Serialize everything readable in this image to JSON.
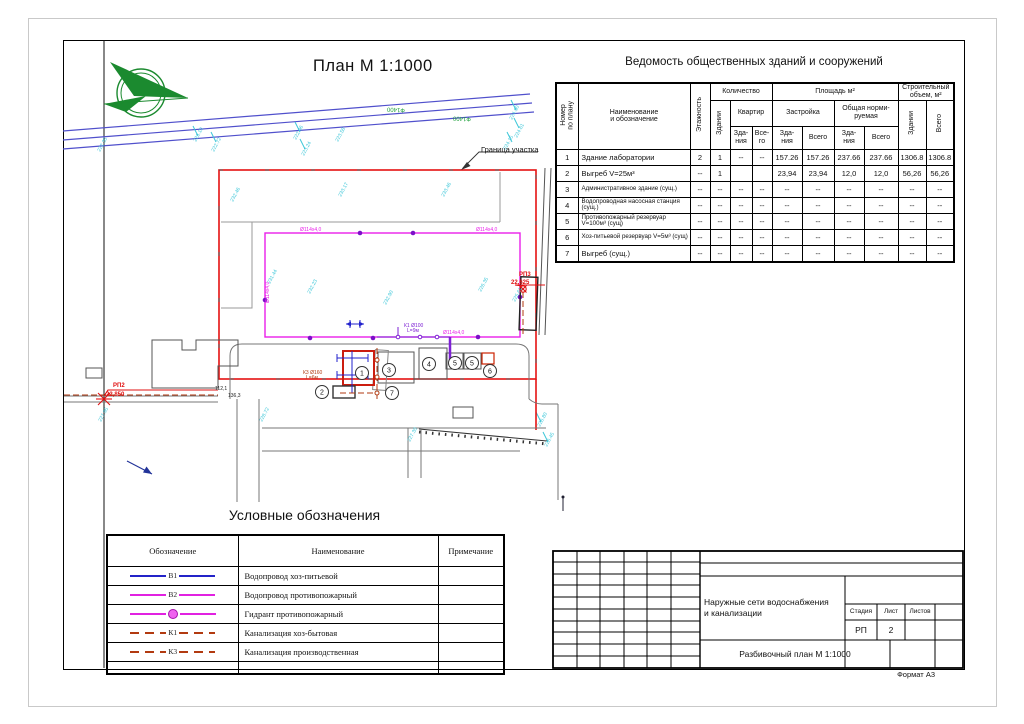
{
  "page": {
    "format_label": "Формат А3"
  },
  "plan": {
    "title": "План М 1:1000",
    "boundary_label": "Граница участка",
    "building_markers": [
      {
        "n": "1",
        "x": 362,
        "y": 373
      },
      {
        "n": "2",
        "x": 322,
        "y": 392
      },
      {
        "n": "3",
        "x": 389,
        "y": 370
      },
      {
        "n": "4",
        "x": 429,
        "y": 364
      },
      {
        "n": "5",
        "x": 455,
        "y": 363
      },
      {
        "n": "5",
        "x": 472,
        "y": 363
      },
      {
        "n": "6",
        "x": 490,
        "y": 371
      },
      {
        "n": "7",
        "x": 392,
        "y": 393
      }
    ],
    "texts": [
      {
        "t": "РП2",
        "x": 113,
        "y": 387,
        "c": "red",
        "s": 6,
        "b": 1
      },
      {
        "t": "22,850",
        "x": 106,
        "y": 396,
        "c": "red",
        "s": 6,
        "b": 1
      },
      {
        "t": "РП3",
        "x": 519,
        "y": 276,
        "c": "red",
        "s": 6,
        "b": 1
      },
      {
        "t": "22,625",
        "x": 511,
        "y": 284,
        "c": "red",
        "s": 6,
        "b": 1
      },
      {
        "t": "Ф1400",
        "x": 396,
        "y": 108,
        "c": "green",
        "s": 6,
        "rot": 183,
        "a": "middle"
      },
      {
        "t": "Ф1400",
        "x": 462,
        "y": 117,
        "c": "green",
        "s": 6,
        "rot": 183,
        "a": "middle"
      },
      {
        "t": "К1 Ø100",
        "x": 404,
        "y": 327,
        "c": "violet",
        "s": 5
      },
      {
        "t": "L=9м",
        "x": 407,
        "y": 332,
        "c": "violet",
        "s": 5
      },
      {
        "t": "К3 Ø160",
        "x": 303,
        "y": 374,
        "c": "darkred",
        "s": 5
      },
      {
        "t": "L=6м",
        "x": 306,
        "y": 379,
        "c": "darkred",
        "s": 5
      },
      {
        "t": "Ø114х4,0",
        "x": 476,
        "y": 231,
        "c": "magenta",
        "s": 5
      },
      {
        "t": "Ø114х4,0",
        "x": 300,
        "y": 231,
        "c": "magenta",
        "s": 5
      },
      {
        "t": "Ø114х4,0",
        "x": 443,
        "y": 334,
        "c": "magenta",
        "s": 5
      },
      {
        "t": "Ø114х4,0",
        "x": 269,
        "y": 303,
        "c": "magenta",
        "s": 5,
        "rot": -90
      },
      {
        "t": "112,1",
        "x": 215,
        "y": 390,
        "c": "black",
        "s": 5
      },
      {
        "t": "136,3",
        "x": 228,
        "y": 397,
        "c": "black",
        "s": 5
      },
      {
        "t": "222.35",
        "x": 100,
        "y": 152,
        "c": "cyan",
        "s": 5,
        "rot": -62
      },
      {
        "t": "223.10",
        "x": 196,
        "y": 142,
        "c": "cyan",
        "s": 5,
        "rot": -62
      },
      {
        "t": "222.72",
        "x": 214,
        "y": 152,
        "c": "cyan",
        "s": 5,
        "rot": -62
      },
      {
        "t": "222.96",
        "x": 296,
        "y": 140,
        "c": "cyan",
        "s": 5,
        "rot": -62
      },
      {
        "t": "223.24",
        "x": 304,
        "y": 156,
        "c": "cyan",
        "s": 5,
        "rot": -62
      },
      {
        "t": "223.58",
        "x": 338,
        "y": 142,
        "c": "cyan",
        "s": 5,
        "rot": -62
      },
      {
        "t": "224.90",
        "x": 512,
        "y": 120,
        "c": "cyan",
        "s": 5,
        "rot": -62
      },
      {
        "t": "224.61",
        "x": 517,
        "y": 138,
        "c": "cyan",
        "s": 5,
        "rot": -62
      },
      {
        "t": "224.15",
        "x": 506,
        "y": 150,
        "c": "cyan",
        "s": 5,
        "rot": -62
      },
      {
        "t": "232.46",
        "x": 233,
        "y": 202,
        "c": "cyan",
        "s": 5,
        "rot": -62
      },
      {
        "t": "233.17",
        "x": 341,
        "y": 197,
        "c": "cyan",
        "s": 5,
        "rot": -62
      },
      {
        "t": "233.46",
        "x": 444,
        "y": 197,
        "c": "cyan",
        "s": 5,
        "rot": -62
      },
      {
        "t": "231.44",
        "x": 270,
        "y": 284,
        "c": "cyan",
        "s": 5,
        "rot": -62
      },
      {
        "t": "232.23",
        "x": 310,
        "y": 294,
        "c": "cyan",
        "s": 5,
        "rot": -62
      },
      {
        "t": "232.90",
        "x": 386,
        "y": 305,
        "c": "cyan",
        "s": 5,
        "rot": -62
      },
      {
        "t": "226.35",
        "x": 481,
        "y": 292,
        "c": "cyan",
        "s": 5,
        "rot": -62
      },
      {
        "t": "225.61",
        "x": 515,
        "y": 302,
        "c": "cyan",
        "s": 5,
        "rot": -62
      },
      {
        "t": "228.72",
        "x": 262,
        "y": 422,
        "c": "cyan",
        "s": 5,
        "rot": -62
      },
      {
        "t": "227.95",
        "x": 101,
        "y": 422,
        "c": "cyan",
        "s": 5,
        "rot": -62
      },
      {
        "t": "227.30",
        "x": 410,
        "y": 442,
        "c": "cyan",
        "s": 5,
        "rot": -62
      },
      {
        "t": "226.80",
        "x": 540,
        "y": 427,
        "c": "cyan",
        "s": 5,
        "rot": -62
      },
      {
        "t": "226.45",
        "x": 547,
        "y": 447,
        "c": "cyan",
        "s": 5,
        "rot": -62
      }
    ]
  },
  "vedomost": {
    "title": "Ведомость общественных зданий и сооружений",
    "h": {
      "num": "Номер\nпо плану",
      "name": "Наименование\nи обозначение",
      "floors": "Этажность",
      "qty": "Количество",
      "bld": "Здании",
      "apt": "Квартир",
      "apt_b": "Зда-\nния",
      "apt_t": "Все-\nго",
      "area": "Площадь м²",
      "built": "Застройка",
      "norm": "Общая норми-\nруемая",
      "b": "Зда-\nния",
      "t": "Всего",
      "vol": "Строительный\nобъем, м²",
      "vol_b": "Здании",
      "vol_t": "Всего"
    },
    "rows": [
      {
        "num": "1",
        "name": "Здание лаборатории",
        "sm": false,
        "cells": [
          "2",
          "1",
          "--",
          "--",
          "157.26",
          "157.26",
          "237.66",
          "237.66",
          "1306.8",
          "1306.8"
        ]
      },
      {
        "num": "2",
        "name": "Выгреб V=25м³",
        "sm": false,
        "cells": [
          "--",
          "1",
          "",
          "",
          "23,94",
          "23,94",
          "12,0",
          "12,0",
          "56,26",
          "56,26"
        ]
      },
      {
        "num": "3",
        "name": "Административное здание (сущ.)",
        "sm": true,
        "cells": [
          "--",
          "--",
          "--",
          "--",
          "--",
          "--",
          "--",
          "--",
          "--",
          "--"
        ]
      },
      {
        "num": "4",
        "name": "Водопроводная насосная станция (сущ.)",
        "sm": true,
        "cells": [
          "--",
          "--",
          "--",
          "--",
          "--",
          "--",
          "--",
          "--",
          "--",
          "--"
        ]
      },
      {
        "num": "5",
        "name": "Противопожарный резервуар V=100м³ (сущ)",
        "sm": true,
        "cells": [
          "--",
          "--",
          "--",
          "--",
          "--",
          "--",
          "--",
          "--",
          "--",
          "--"
        ]
      },
      {
        "num": "6",
        "name": "Хоз-питьевой резервуар V=5м³ (сущ)",
        "sm": true,
        "cells": [
          "--",
          "--",
          "--",
          "--",
          "--",
          "--",
          "--",
          "--",
          "--",
          "--"
        ]
      },
      {
        "num": "7",
        "name": "Выгреб (сущ.)",
        "sm": false,
        "cells": [
          "--",
          "--",
          "--",
          "--",
          "--",
          "--",
          "--",
          "--",
          "--",
          "--"
        ]
      }
    ]
  },
  "legend": {
    "title": "Условные обозначения",
    "headers": [
      "Обозначение",
      "Наименование",
      "Примечание"
    ],
    "rows": [
      {
        "code": "В1",
        "name": "Водопровод хоз-питьевой",
        "style": "solid",
        "color": "#2323c8"
      },
      {
        "code": "В2",
        "name": "Водопровод противопожарный",
        "style": "solid",
        "color": "#e121e1"
      },
      {
        "code": "",
        "name": "Гидрант противопожарный",
        "style": "hydrant",
        "color": "#e121e1"
      },
      {
        "code": "К1",
        "name": "Канализация хоз-бытовая",
        "style": "dash",
        "color": "#b23a10"
      },
      {
        "code": "К3",
        "name": "Канализация производственная",
        "style": "dash",
        "color": "#b23a10"
      },
      {
        "code": "",
        "name": "",
        "style": "none",
        "color": ""
      }
    ]
  },
  "stamp": {
    "project": "Наружные сети водоснабжения и канализации",
    "stage_label": "Стадия",
    "sheet_label": "Лист",
    "sheets_label": "Листов",
    "stage": "РП",
    "sheet": "2",
    "sheets": "",
    "doc_title": "Разбивочный план М 1:1000"
  }
}
